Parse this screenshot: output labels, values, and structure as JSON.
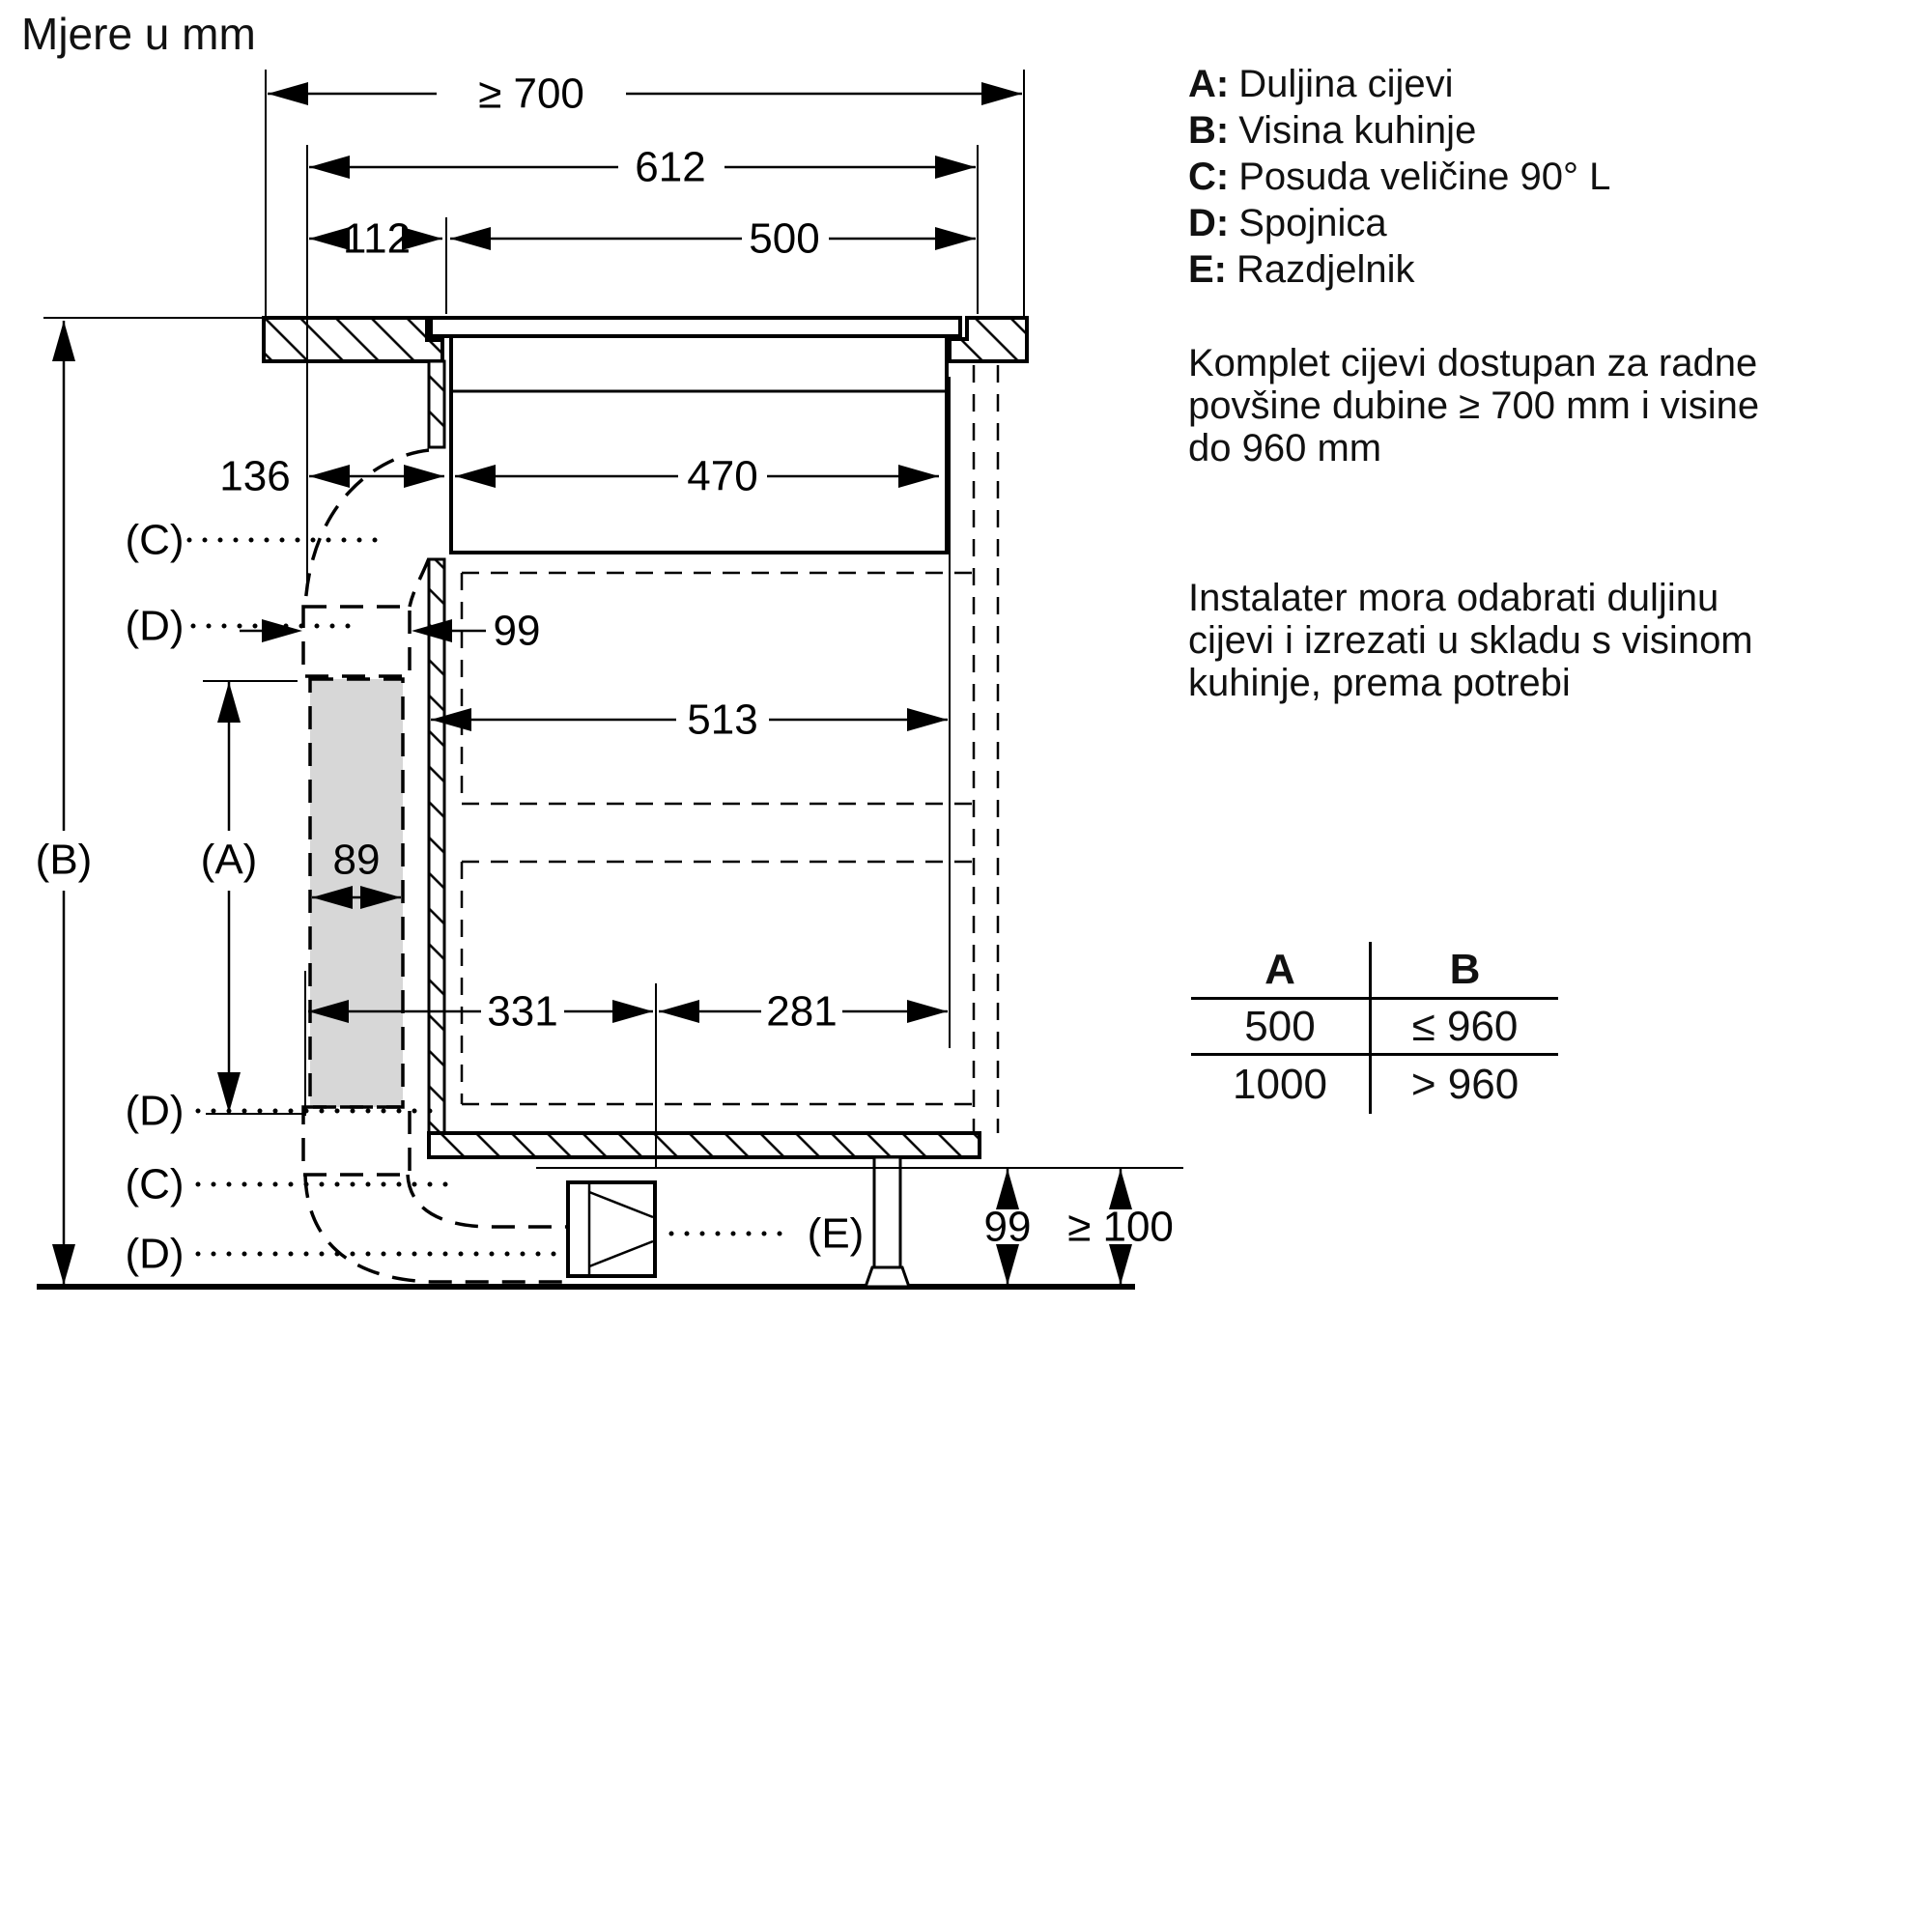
{
  "title": "Mjere u mm",
  "legend": {
    "items": [
      {
        "key": "A:",
        "label": "Duljina cijevi"
      },
      {
        "key": "B:",
        "label": "Visina kuhinje"
      },
      {
        "key": "C:",
        "label": "Posuda veličine 90° L"
      },
      {
        "key": "D:",
        "label": "Spojnica"
      },
      {
        "key": "E:",
        "label": "Razdjelnik"
      }
    ]
  },
  "notes": {
    "note1": [
      "Komplet cijevi dostupan za radne",
      "povšine dubine ≥ 700 mm i visine",
      "do 960 mm"
    ],
    "note2": [
      "Instalater mora odabrati duljinu",
      "cijevi i izrezati u skladu s visinom",
      "kuhinje, prema potrebi"
    ]
  },
  "table": {
    "header": [
      "A",
      "B"
    ],
    "rows": [
      [
        "500",
        "≤ 960"
      ],
      [
        "1000",
        "> 960"
      ]
    ]
  },
  "dims": {
    "worktop_depth": "≥ 700",
    "hob_total_width": "612",
    "front_offset": "112",
    "cutout_width": "500",
    "rear_gap": "136",
    "hob_body_width": "470",
    "connector_width_top": "99",
    "cabinet_inner_depth": "513",
    "duct_width": "89",
    "duct_offset_front": "331",
    "duct_offset_rear": "281",
    "plinth_duct_height": "99",
    "floor_clearance": "≥ 100"
  },
  "callouts": {
    "a": "(A)",
    "b": "(B)",
    "c": "(C)",
    "d": "(D)",
    "e": "(E)"
  }
}
